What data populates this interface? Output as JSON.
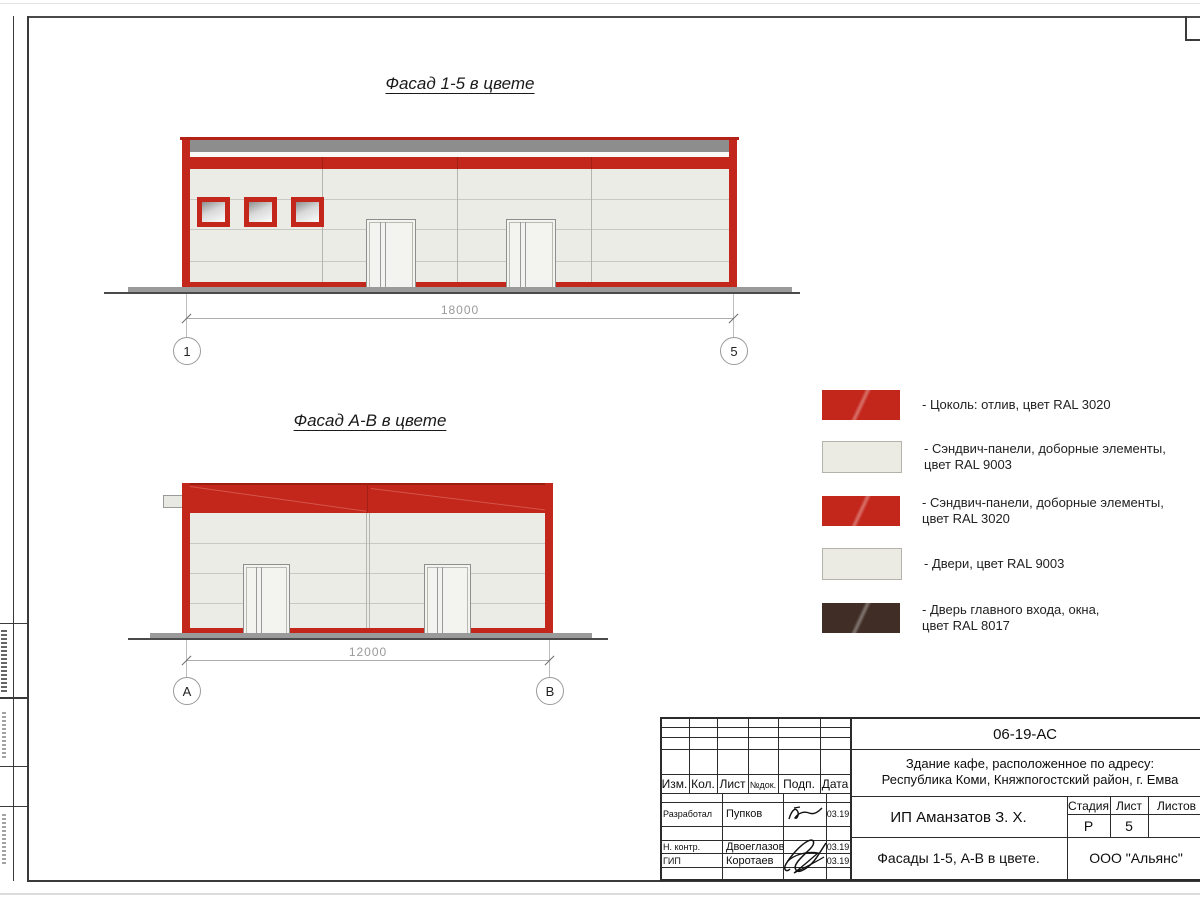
{
  "sheet": {
    "facade15": {
      "title": "Фасад 1-5 в цвете",
      "dimension": "18000",
      "axis_left": "1",
      "axis_right": "5"
    },
    "facadeAB": {
      "title": "Фасад А-В в цвете",
      "dimension": "12000",
      "axis_left": "А",
      "axis_right": "В"
    },
    "legend": {
      "items": [
        {
          "color": "#c3261b",
          "line1": "- Цоколь: отлив, цвет RAL 3020",
          "line2": ""
        },
        {
          "color": "#ebebe4",
          "line1": "- Сэндвич-панели, доборные элементы,",
          "line2": "цвет RAL 9003"
        },
        {
          "color": "#c3261b",
          "line1": "- Сэндвич-панели, доборные элементы,",
          "line2": "цвет RAL 3020"
        },
        {
          "color": "#ebebe4",
          "line1": "- Двери, цвет RAL 9003",
          "line2": ""
        },
        {
          "color": "#3f2d26",
          "line1": "- Дверь главного входа, окна,",
          "line2": "цвет RAL 8017"
        }
      ]
    },
    "titleblock": {
      "doc_number": "06-19-АС",
      "object_line1": "Здание кафе, расположенное по адресу:",
      "object_line2": "Республика Коми, Княжпогостский район, г. Емва",
      "client": "ИП Аманзатов З. Х.",
      "sheet_name": "Фасады 1-5, А-В в цвете.",
      "company": "ООО \"Альянс\"",
      "col_izm": "Изм.",
      "col_kol": "Кол.",
      "col_list": "Лист",
      "col_ndok": "№док.",
      "col_podp": "Подп.",
      "col_data": "Дата",
      "col_stadia": "Стадия",
      "col_sheet": "Лист",
      "col_sheets": "Листов",
      "stage": "Р",
      "sheet_number": "5",
      "row_developed_role": "Разработал",
      "row_developed_name": "Пупков",
      "row_developed_date": "03.19",
      "row_ncontr_role": "Н. контр.",
      "row_ncontr_name": "Двоеглазов",
      "row_ncontr_date": "03.19",
      "row_gip_role": "ГИП",
      "row_gip_name": "Коротаев",
      "row_gip_date": "03.19"
    },
    "colors": {
      "red": "#c3261b",
      "panel": "#ecece6",
      "band": "#8d8d8d",
      "brown": "#3f2d26"
    }
  }
}
